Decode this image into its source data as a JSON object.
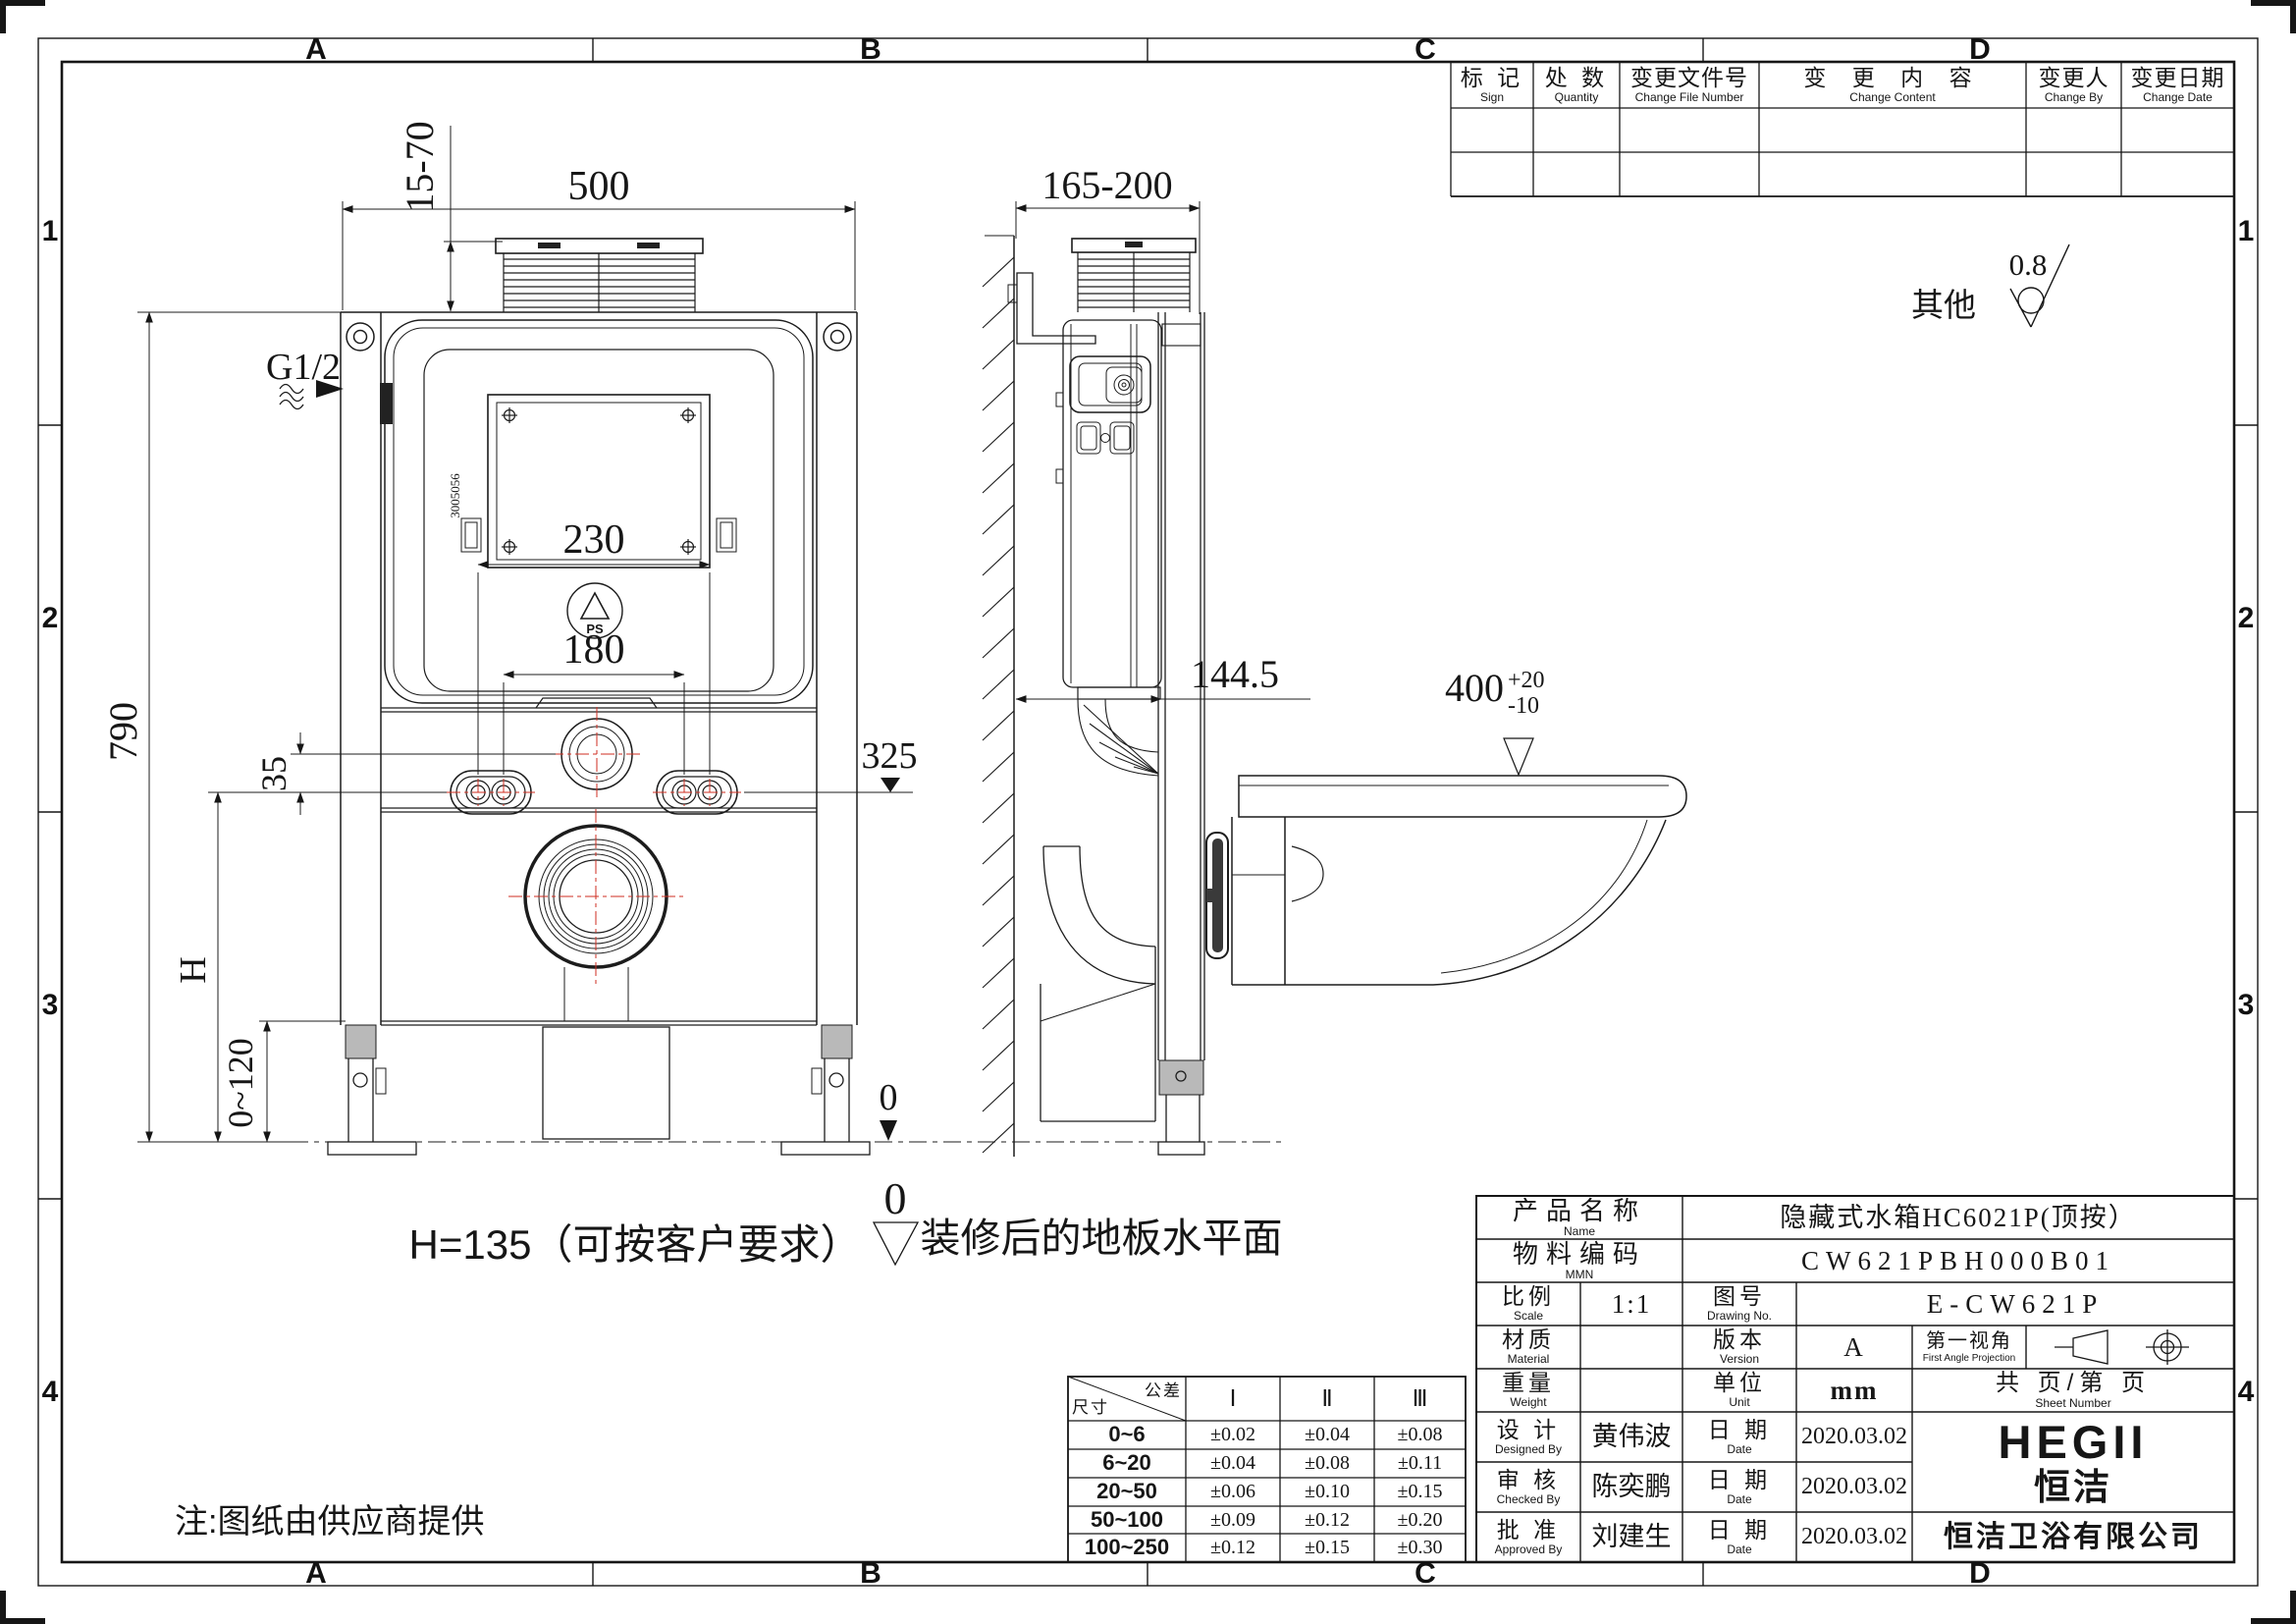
{
  "sheet": {
    "zones_top": [
      "A",
      "B",
      "C",
      "D"
    ],
    "zones_bottom": [
      "A",
      "B",
      "C",
      "D"
    ],
    "zones_left": [
      "1",
      "2",
      "3",
      "4"
    ],
    "zones_right": [
      "1",
      "2",
      "3",
      "4"
    ]
  },
  "revision_table": {
    "headers": [
      {
        "cn": "标 记",
        "en": "Sign"
      },
      {
        "cn": "处 数",
        "en": "Quantity"
      },
      {
        "cn": "变更文件号",
        "en": "Change File Number"
      },
      {
        "cn": "变 更 内 容",
        "en": "Change Content"
      },
      {
        "cn": "变更人",
        "en": "Change By"
      },
      {
        "cn": "变更日期",
        "en": "Change Date"
      }
    ]
  },
  "roughness": {
    "other_label": "其他",
    "value": "0.8"
  },
  "front_view": {
    "dim_width": "500",
    "dim_shaft": "15-70",
    "inlet": "G1/2",
    "dim_outer_holes": "230",
    "dim_inner_holes": "180",
    "dim_offset": "35",
    "dim_height": "H",
    "dim_frame_height": "790",
    "dim_hole_level": "325",
    "dim_foot_adjust": "0~120",
    "floor_zero": "0",
    "panel_code": "3005056",
    "ps_label": "PS"
  },
  "side_view": {
    "dim_depth": "165-200",
    "dim_front": "144.5",
    "dim_bowl_height": "400",
    "tol_plus": "+20",
    "tol_minus": "-10"
  },
  "notes": {
    "height_note": "H=135（可按客户要求）",
    "datum_zero": "0",
    "floor_note": "装修后的地板水平面",
    "supplier_note": "注:图纸由供应商提供"
  },
  "tolerance_table": {
    "corner_top": "公差",
    "corner_bottom": "尺寸",
    "cols": [
      "Ⅰ",
      "Ⅱ",
      "Ⅲ"
    ],
    "rows": [
      {
        "range": "0~6",
        "v": [
          "±0.02",
          "±0.04",
          "±0.08"
        ]
      },
      {
        "range": "6~20",
        "v": [
          "±0.04",
          "±0.08",
          "±0.11"
        ]
      },
      {
        "range": "20~50",
        "v": [
          "±0.06",
          "±0.10",
          "±0.15"
        ]
      },
      {
        "range": "50~100",
        "v": [
          "±0.09",
          "±0.12",
          "±0.20"
        ]
      },
      {
        "range": "100~250",
        "v": [
          "±0.12",
          "±0.15",
          "±0.30"
        ]
      }
    ]
  },
  "title_block": {
    "name_label": "产品名称",
    "name_en": "Name",
    "name_value": "隐藏式水箱HC6021P(顶按）",
    "mmn_label": "物料编码",
    "mmn_en": "MMN",
    "mmn_value": "CW621PBH000B01",
    "scale_label": "比例",
    "scale_en": "Scale",
    "scale_value": "1:1",
    "drawing_label": "图号",
    "drawing_en": "Drawing No.",
    "drawing_value": "E-CW621P",
    "material_label": "材质",
    "material_en": "Material",
    "material_value": "",
    "version_label": "版本",
    "version_en": "Version",
    "version_value": "A",
    "projection_label": "第一视角",
    "projection_en": "First Angle Projection",
    "weight_label": "重量",
    "weight_en": "Weight",
    "weight_value": "",
    "unit_label": "单位",
    "unit_en": "Unit",
    "unit_value": "mm",
    "sheet_label": "共 页/第 页",
    "sheet_en": "Sheet Number",
    "designed_label": "设 计",
    "designed_en": "Designed By",
    "designer": "黄伟波",
    "checked_label": "审 核",
    "checked_en": "Checked By",
    "checker": "陈奕鹏",
    "approved_label": "批 准",
    "approved_en": "Approved By",
    "approver": "刘建生",
    "date_label": "日 期",
    "date_en": "Date",
    "design_date": "2020.03.02",
    "check_date": "2020.03.02",
    "approve_date": "2020.03.02",
    "brand": "HEGII",
    "brand_cn": "恒洁",
    "company": "恒洁卫浴有限公司"
  }
}
